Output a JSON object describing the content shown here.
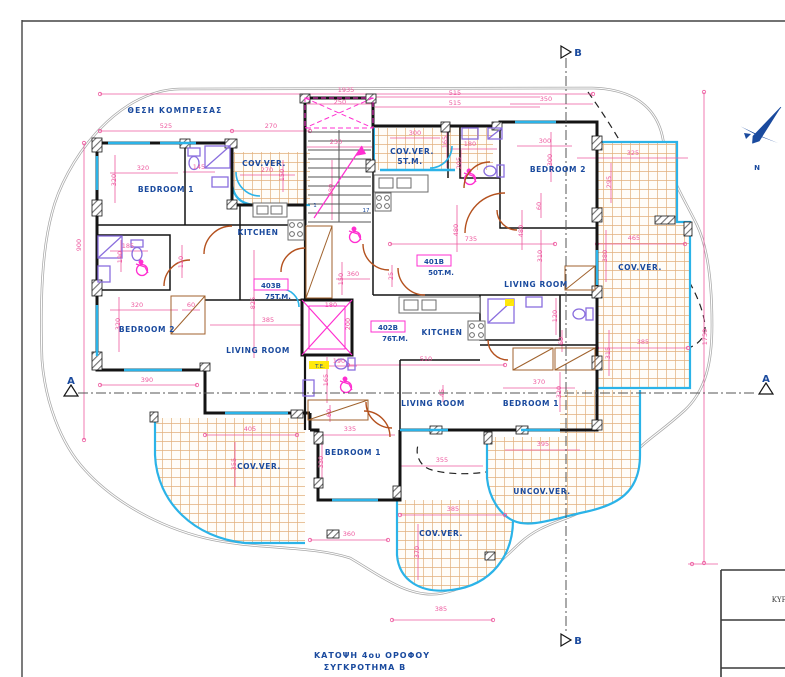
{
  "header_label": "ΘΕΣΗ ΚΟΜΠΡΕΣΑΣ",
  "title": {
    "line1": "ΚΑΤΟΨΗ 4ου ΟΡΟΦΟΥ",
    "line2": "ΣΥΓΚΡΟΤΗΜΑ Β"
  },
  "north": {
    "label": "N"
  },
  "section_markers": {
    "top": "B",
    "bottom": "B",
    "left": "A",
    "right": "A"
  },
  "titleblock": {
    "text": "ΚΥΡ"
  },
  "apartments": [
    {
      "id": "403B",
      "area": "75T.M.",
      "x": 271,
      "y": 288
    },
    {
      "id": "401B",
      "area": "50T.M.",
      "x": 434,
      "y": 264
    },
    {
      "id": "402B",
      "area": "76T.M.",
      "x": 388,
      "y": 330
    }
  ],
  "rooms": [
    {
      "label": "BEDROOM 1",
      "x": 166,
      "y": 192
    },
    {
      "label": "BEDROOM 2",
      "x": 147,
      "y": 332
    },
    {
      "label": "KITCHEN",
      "x": 258,
      "y": 235
    },
    {
      "label": "LIVING ROOM",
      "x": 258,
      "y": 353
    },
    {
      "label": "COV.VER.",
      "x": 264,
      "y": 166
    },
    {
      "label": "COV.VER.",
      "x": 412,
      "y": 154
    },
    {
      "label": "5T.M.",
      "x": 410,
      "y": 164
    },
    {
      "label": "BEDROOM 2",
      "x": 558,
      "y": 172
    },
    {
      "label": "LIVING ROOM",
      "x": 536,
      "y": 287
    },
    {
      "label": "COV.VER.",
      "x": 640,
      "y": 270
    },
    {
      "label": "KITCHEN",
      "x": 442,
      "y": 335
    },
    {
      "label": "LIVING ROOM",
      "x": 433,
      "y": 406
    },
    {
      "label": "BEDROOM 1",
      "x": 531,
      "y": 406
    },
    {
      "label": "BEDROOM 1",
      "x": 353,
      "y": 455
    },
    {
      "label": "COV.VER.",
      "x": 259,
      "y": 469
    },
    {
      "label": "UNCOV.VER.",
      "x": 542,
      "y": 494
    },
    {
      "label": "COV.VER.",
      "x": 441,
      "y": 536
    }
  ],
  "stair_numbers": [
    {
      "v": "1",
      "x": 315,
      "y": 207
    },
    {
      "v": "17",
      "x": 366,
      "y": 212
    }
  ],
  "special_labels": [
    {
      "text": "T.E.",
      "x": 320,
      "y": 368
    }
  ],
  "dimensions": [
    {
      "v": "1935",
      "x": 346,
      "y": 92
    },
    {
      "v": "515",
      "x": 455,
      "y": 95
    },
    {
      "v": "515",
      "x": 455,
      "y": 105
    },
    {
      "v": "250",
      "x": 340,
      "y": 104
    },
    {
      "v": "350",
      "x": 546,
      "y": 101
    },
    {
      "v": "525",
      "x": 166,
      "y": 128
    },
    {
      "v": "270",
      "x": 271,
      "y": 128
    },
    {
      "v": "250",
      "x": 336,
      "y": 144
    },
    {
      "v": "300",
      "x": 415,
      "y": 135
    },
    {
      "v": "165",
      "x": 447,
      "y": 142,
      "r": 1
    },
    {
      "v": "180",
      "x": 470,
      "y": 146
    },
    {
      "v": "205",
      "x": 461,
      "y": 163,
      "r": 1
    },
    {
      "v": "300",
      "x": 545,
      "y": 143
    },
    {
      "v": "300",
      "x": 552,
      "y": 160,
      "r": 1
    },
    {
      "v": "325",
      "x": 633,
      "y": 155
    },
    {
      "v": "295",
      "x": 611,
      "y": 182,
      "r": 1
    },
    {
      "v": "60",
      "x": 541,
      "y": 206,
      "r": 1
    },
    {
      "v": "900",
      "x": 81,
      "y": 245,
      "r": 1
    },
    {
      "v": "320",
      "x": 143,
      "y": 170
    },
    {
      "v": "320",
      "x": 116,
      "y": 180,
      "r": 1
    },
    {
      "v": "145",
      "x": 199,
      "y": 169
    },
    {
      "v": "270",
      "x": 267,
      "y": 172
    },
    {
      "v": "150",
      "x": 284,
      "y": 175,
      "r": 1
    },
    {
      "v": "480",
      "x": 333,
      "y": 190,
      "r": 1
    },
    {
      "v": "185",
      "x": 128,
      "y": 248
    },
    {
      "v": "190",
      "x": 122,
      "y": 257,
      "r": 1
    },
    {
      "v": "110",
      "x": 183,
      "y": 262,
      "r": 1
    },
    {
      "v": "480",
      "x": 458,
      "y": 230,
      "r": 1
    },
    {
      "v": "480",
      "x": 523,
      "y": 231,
      "r": 1
    },
    {
      "v": "735",
      "x": 471,
      "y": 241
    },
    {
      "v": "310",
      "x": 542,
      "y": 256,
      "r": 1
    },
    {
      "v": "150",
      "x": 343,
      "y": 279,
      "r": 1
    },
    {
      "v": "360",
      "x": 353,
      "y": 276
    },
    {
      "v": "25",
      "x": 393,
      "y": 276,
      "r": 1
    },
    {
      "v": "825",
      "x": 255,
      "y": 303,
      "r": 1
    },
    {
      "v": "385",
      "x": 268,
      "y": 322
    },
    {
      "v": "320",
      "x": 137,
      "y": 307
    },
    {
      "v": "320",
      "x": 120,
      "y": 324,
      "r": 1
    },
    {
      "v": "60",
      "x": 191,
      "y": 307
    },
    {
      "v": "390",
      "x": 147,
      "y": 382
    },
    {
      "v": "180",
      "x": 331,
      "y": 307
    },
    {
      "v": "200",
      "x": 350,
      "y": 324,
      "r": 1
    },
    {
      "v": "190",
      "x": 339,
      "y": 363
    },
    {
      "v": "165",
      "x": 328,
      "y": 380,
      "r": 1
    },
    {
      "v": "60",
      "x": 331,
      "y": 413,
      "r": 1
    },
    {
      "v": "510",
      "x": 426,
      "y": 361
    },
    {
      "v": "120",
      "x": 557,
      "y": 316,
      "r": 1
    },
    {
      "v": "60",
      "x": 563,
      "y": 341,
      "r": 1
    },
    {
      "v": "370",
      "x": 539,
      "y": 384
    },
    {
      "v": "320",
      "x": 561,
      "y": 392,
      "r": 1
    },
    {
      "v": "45",
      "x": 444,
      "y": 393,
      "r": 1
    },
    {
      "v": "405",
      "x": 250,
      "y": 431
    },
    {
      "v": "355",
      "x": 236,
      "y": 464,
      "r": 1
    },
    {
      "v": "335",
      "x": 350,
      "y": 431
    },
    {
      "v": "330",
      "x": 323,
      "y": 462,
      "r": 1
    },
    {
      "v": "355",
      "x": 442,
      "y": 462
    },
    {
      "v": "395",
      "x": 543,
      "y": 446
    },
    {
      "v": "385",
      "x": 453,
      "y": 511
    },
    {
      "v": "370",
      "x": 419,
      "y": 552,
      "r": 1
    },
    {
      "v": "360",
      "x": 349,
      "y": 536
    },
    {
      "v": "385",
      "x": 441,
      "y": 611
    },
    {
      "v": "465",
      "x": 634,
      "y": 240
    },
    {
      "v": "380",
      "x": 607,
      "y": 256,
      "r": 1
    },
    {
      "v": "315",
      "x": 610,
      "y": 353,
      "r": 1
    },
    {
      "v": "385",
      "x": 643,
      "y": 344
    },
    {
      "v": "1750",
      "x": 707,
      "y": 337,
      "r": 1
    }
  ],
  "colors": {
    "dimension": "#ee5ba0",
    "room_text": "#1a4a9e",
    "veranda_edge": "#2bb3e8",
    "tile": "#e2b07c",
    "door": "#b4511e",
    "magenta": "#ff2fd0",
    "wall": "#141414"
  }
}
